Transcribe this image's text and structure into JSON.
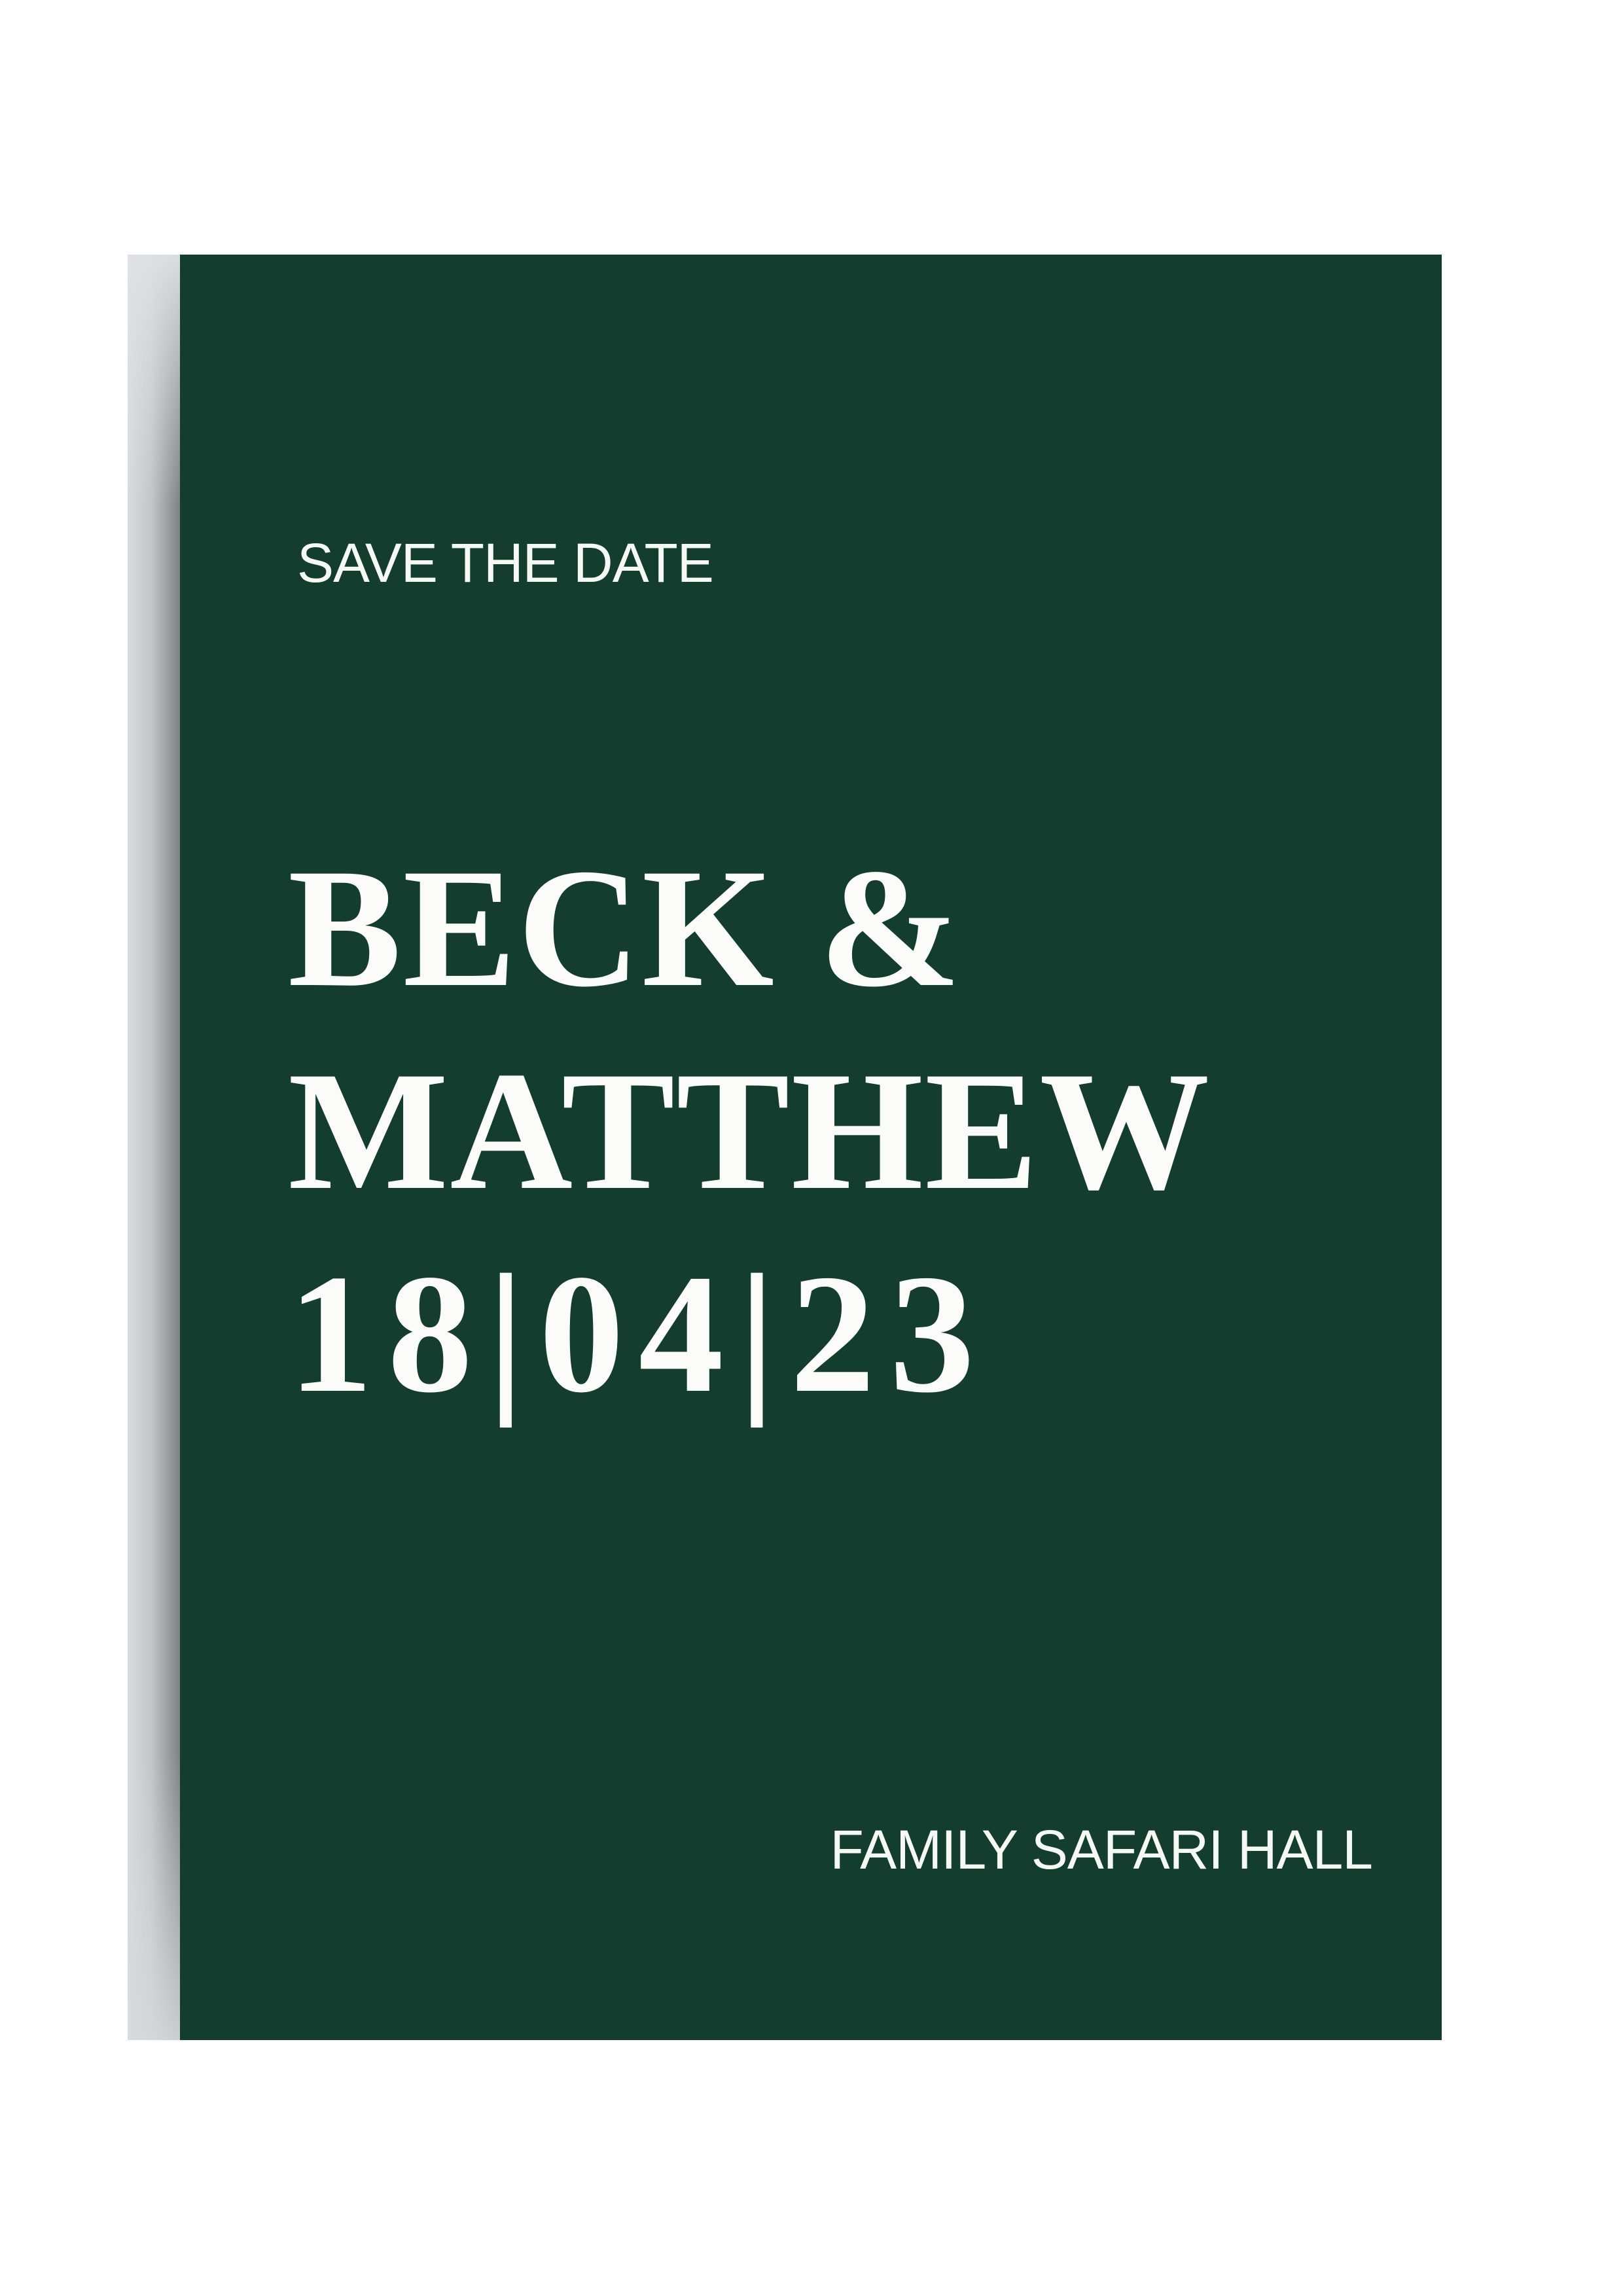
{
  "page": {
    "background_color": "#ffffff"
  },
  "card": {
    "background_color": "#123d2f",
    "text_color": "#f6f8f5",
    "shadow_colors": [
      "#d9dcde",
      "#7f8285"
    ],
    "eyebrow": "SAVE THE DATE",
    "names_line1": "BECK &",
    "names_line2": "MATTHEW",
    "date": "18|04|23",
    "venue": "FAMILY SAFARI HALL"
  }
}
